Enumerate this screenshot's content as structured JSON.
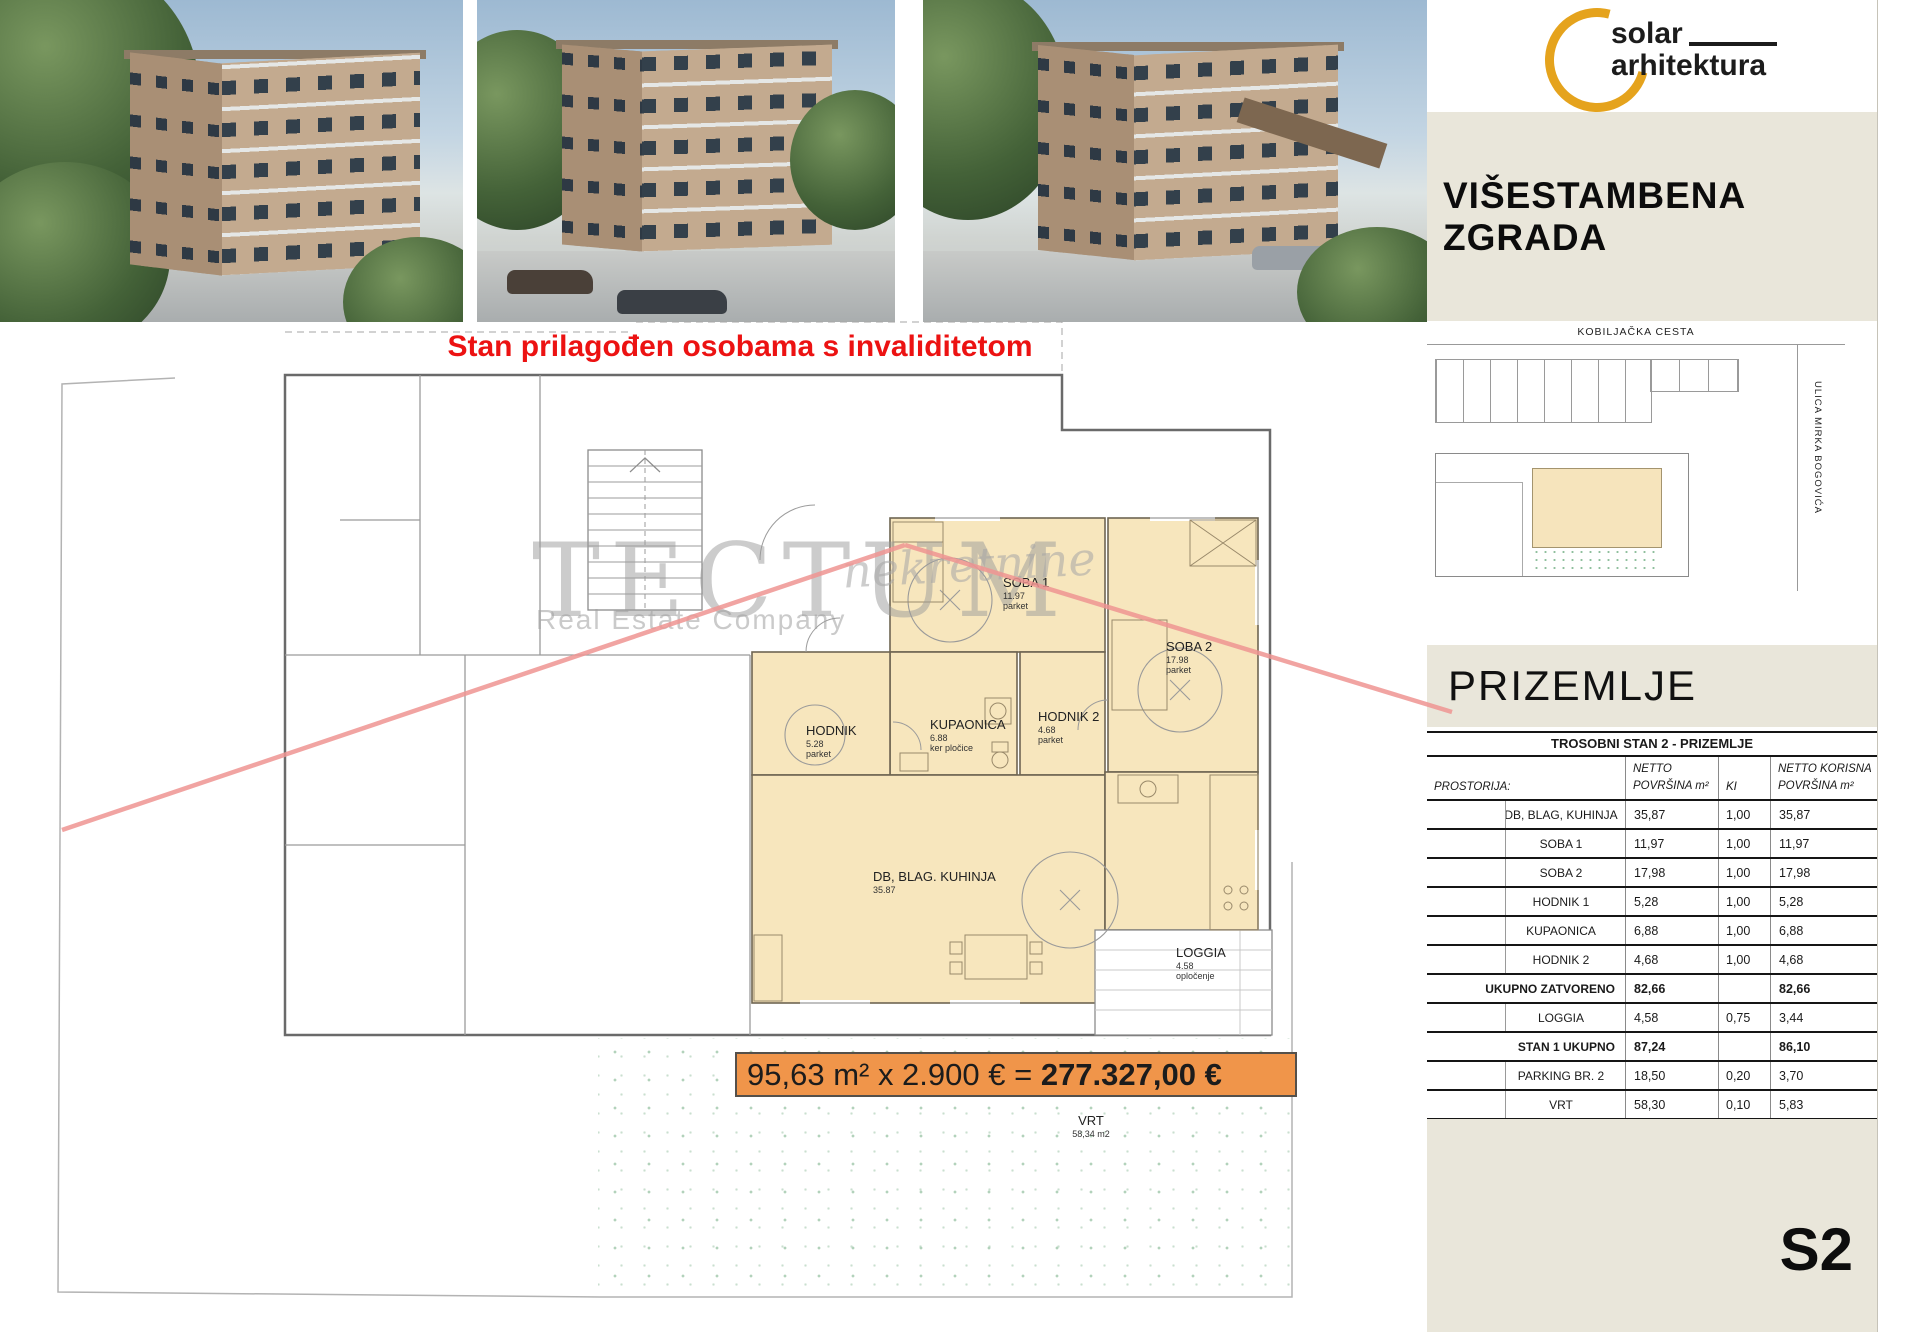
{
  "header": {
    "logo": {
      "line1": "solar",
      "line2": "arhitektura",
      "accent_color": "#e5a31d"
    },
    "title": "VIŠESTAMBENA  ZGRADA"
  },
  "headline": "Stan prilagođen osobama s invaliditetom",
  "watermark": {
    "brand": "TECTUM",
    "script": "nekretnine",
    "subtitle": "Real Estate Company"
  },
  "siteplan": {
    "street_top": "KOBILJAČKA CESTA",
    "street_right": "ULICA MIRKA BOGOVIĆA"
  },
  "section": {
    "floor_label": "PRIZEMLJE",
    "sheet_code": "S2"
  },
  "price": {
    "formula": "95,63 m² x 2.900 € = ",
    "total": "277.327,00 €",
    "banner_color": "#f0954a"
  },
  "plan": {
    "rooms": {
      "soba1": {
        "name": "SOBA 1",
        "area": "11.97",
        "finish": "parket"
      },
      "soba2": {
        "name": "SOBA 2",
        "area": "17.98",
        "finish": "parket"
      },
      "hodnik": {
        "name": "HODNIK",
        "area": "5.28",
        "finish": "parket"
      },
      "kupaonica": {
        "name": "KUPAONICA",
        "area": "6.88",
        "finish": "ker pločice"
      },
      "hodnik2": {
        "name": "HODNIK 2",
        "area": "4.68",
        "finish": "parket"
      },
      "db": {
        "name": "DB, BLAG. KUHINJA",
        "area": "35.87",
        "finish": ""
      },
      "loggia": {
        "name": "LOGGIA",
        "area": "4.58",
        "finish": "opločenje"
      },
      "vrt": {
        "name": "VRT",
        "area": "58,34 m2",
        "finish": ""
      }
    },
    "highlight_color": "#f7e6bd"
  },
  "table": {
    "title": "TROSOBNI STAN 2 - PRIZEMLJE",
    "headers": {
      "col1": "PROSTORIJA:",
      "col2": "NETTO POVRŠINA m²",
      "col3": "KI",
      "col4": "NETTO KORISNA POVRŠINA m²"
    },
    "rows": [
      {
        "label": "DB, BLAG, KUHINJA",
        "netto": "35,87",
        "ki": "1,00",
        "korisna": "35,87",
        "bold": false
      },
      {
        "label": "SOBA 1",
        "netto": "11,97",
        "ki": "1,00",
        "korisna": "11,97",
        "bold": false
      },
      {
        "label": "SOBA 2",
        "netto": "17,98",
        "ki": "1,00",
        "korisna": "17,98",
        "bold": false
      },
      {
        "label": "HODNIK 1",
        "netto": "5,28",
        "ki": "1,00",
        "korisna": "5,28",
        "bold": false
      },
      {
        "label": "KUPAONICA",
        "netto": "6,88",
        "ki": "1,00",
        "korisna": "6,88",
        "bold": false
      },
      {
        "label": "HODNIK 2",
        "netto": "4,68",
        "ki": "1,00",
        "korisna": "4,68",
        "bold": false
      },
      {
        "label": "UKUPNO ZATVORENO",
        "netto": "82,66",
        "ki": "",
        "korisna": "82,66",
        "bold": true
      },
      {
        "label": "LOGGIA",
        "netto": "4,58",
        "ki": "0,75",
        "korisna": "3,44",
        "bold": false
      },
      {
        "label": "STAN 1 UKUPNO",
        "netto": "87,24",
        "ki": "",
        "korisna": "86,10",
        "bold": true
      },
      {
        "label": "PARKING BR. 2",
        "netto": "18,50",
        "ki": "0,20",
        "korisna": "3,70",
        "bold": false
      },
      {
        "label": "VRT",
        "netto": "58,30",
        "ki": "0,10",
        "korisna": "5,83",
        "bold": false
      },
      {
        "label": "STAN 2 SVEUKUPNO",
        "netto": "164,04",
        "ki": "",
        "korisna": "95,63",
        "bold": true
      }
    ]
  },
  "colors": {
    "sidebar_beige": "#e9e6da",
    "headline_red": "#ec1212",
    "callout_pink": "#ef9492"
  }
}
